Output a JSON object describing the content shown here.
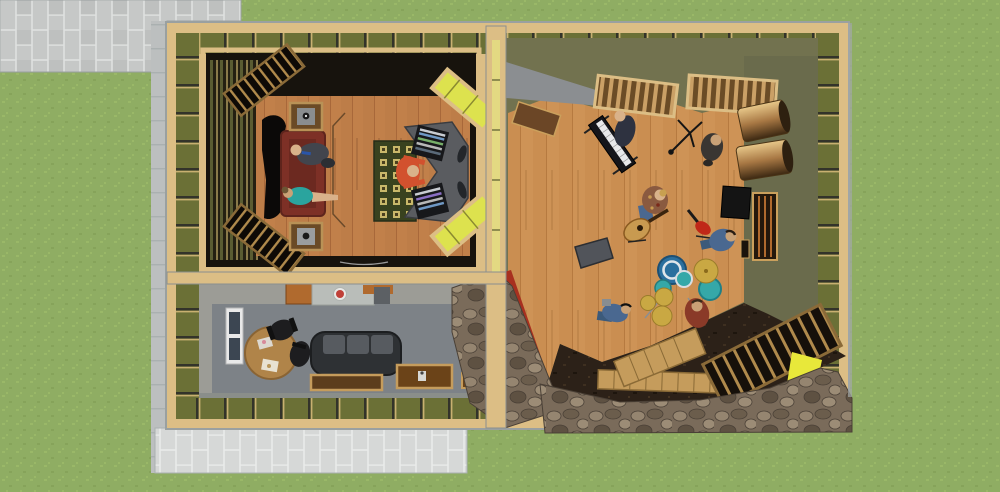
{
  "scene": {
    "type": "3d-architectural-render",
    "subject": "recording-studio floor plan, top-down cutaway view",
    "areas": [
      "control-room",
      "live-room",
      "lounge",
      "paver-patio",
      "concrete-walkway",
      "lawn",
      "stone-wall-path"
    ],
    "people": [
      {
        "id": "engineer-at-console",
        "location": "control-room",
        "shirt": "#d2512e"
      },
      {
        "id": "man-in-suit",
        "location": "control-room-couch",
        "shirt": "#42454d"
      },
      {
        "id": "woman-in-teal",
        "location": "control-room-couch",
        "shirt": "#2aa49e"
      },
      {
        "id": "keyboardist",
        "location": "live-room",
        "shirt": "#2e3240"
      },
      {
        "id": "vocalist-at-mic",
        "location": "live-room",
        "shirt": "#3a3632"
      },
      {
        "id": "acoustic-guitarist",
        "location": "live-room",
        "shirt": "#8a5a40"
      },
      {
        "id": "seated-bassist",
        "location": "live-room",
        "shirt": "#4a6890"
      },
      {
        "id": "drummer",
        "location": "live-room",
        "shirt": "#8a3a28"
      },
      {
        "id": "technician-on-floor",
        "location": "live-room",
        "shirt": "#4a6890"
      }
    ],
    "objects": [
      "mixing-console",
      "equipment-racks",
      "area-rug",
      "couch",
      "speaker-cabinets",
      "bass-traps",
      "splayed-window-panels",
      "drum-kit",
      "keyboard",
      "mic-stand",
      "acoustic-guitar",
      "electric-guitar",
      "guitar-amp",
      "stage-monitor",
      "ceiling-slat-diffusers",
      "poly-cylinder-diffusers",
      "leaning-slat-panel",
      "kitchenette",
      "round-table",
      "office-chairs",
      "lounge-sofa",
      "coffee-tables",
      "window",
      "doors",
      "wood-plank-walkway",
      "red-accent-wall",
      "yellow-insulation-patch"
    ]
  },
  "colors": {
    "grass": "#8fad63",
    "grassLight": "#9ab868",
    "grassDark": "#86a35a",
    "paver": "#c6c8c7",
    "paverJoint": "#dfe1e0",
    "paverAlt": "#bec0bf",
    "paverLight": "#d6d8d7",
    "paverLightJoint": "#e9ebea",
    "concrete": "#bcbfbf",
    "concreteLine": "#aab0b0",
    "sheath": "#a3a8a8",
    "plywood": "#dcbe85",
    "plywoodEdge": "#b99256",
    "bays": "#6b7036",
    "baysLine": "#33332a",
    "stud": "#c8b070",
    "dividerYellow": "#e3d982",
    "insulBright": "#dde24e",
    "insulPatch": "#e8e83a",
    "crFloor": "#c1804a",
    "crFloorLine": "#a8683a",
    "crDark": "#17130d",
    "lrFloor": "#ce9356",
    "lrFloorLine": "#b67a40",
    "lrWall": "#72724f",
    "lrWallDark": "#6a6b4c",
    "loungeFloor": "#7d8287",
    "loungeWall": "#9c9c96",
    "couch": "#7d3026",
    "couchDark": "#5e241c",
    "rugBase": "#39421f",
    "rugSquare": "#c9b86a",
    "console": "#5a5c60",
    "rack": "#17181b",
    "stoneBase": "#7a6b5a",
    "stoneA": "#958570",
    "stoneB": "#6b5d4c",
    "stoneC": "#9c8c76",
    "stoneD": "#5e5142",
    "stoneJoint": "#4a4036",
    "redWall": "#a8301f",
    "dirt": "#2c2118",
    "plank": "#c59c5c",
    "plankLine": "#8a6a36",
    "slatDark": "#16100a",
    "slatLight": "#b08a4c",
    "slatOlive": "#5a5c32",
    "ceilSlat": "#6b4c26",
    "ceilSlatLight": "#caa066",
    "cylLight": "#e8c88a",
    "cylMid": "#a87844",
    "cylDark": "#3c2812",
    "door": "#6b4626",
    "grayPanel": "#8b8e91",
    "sofa": "#2e3134",
    "sofaCushion": "#575b60",
    "chairBlack": "#1d1d1f",
    "tableWood": "#b08449",
    "granite": "#b9bdb9",
    "cabinet": "#b06a2e",
    "appliance": "#5c6064",
    "redItem": "#c04038",
    "windowFrame": "#e9e9e9",
    "windowPane": "#3c4652",
    "skin": "#d9b28a",
    "skinDark": "#c9a176",
    "suit": "#42454d",
    "tealShirt": "#2aa49e",
    "orangeShirt": "#d2512e",
    "navy": "#2e3240",
    "drummerShirt": "#8a3a28",
    "jeans": "#4a6890",
    "jeansDark": "#3c5a7a",
    "guitaristShirt": "#8a5a40",
    "drumBlue": "#2a6f9e",
    "drumTeal": "#35a8a8",
    "cymbal": "#c9a843",
    "amp": "#141414",
    "monitorWedge": "#51545a",
    "guitarTan": "#c89a50",
    "redGuitar": "#c02818"
  }
}
